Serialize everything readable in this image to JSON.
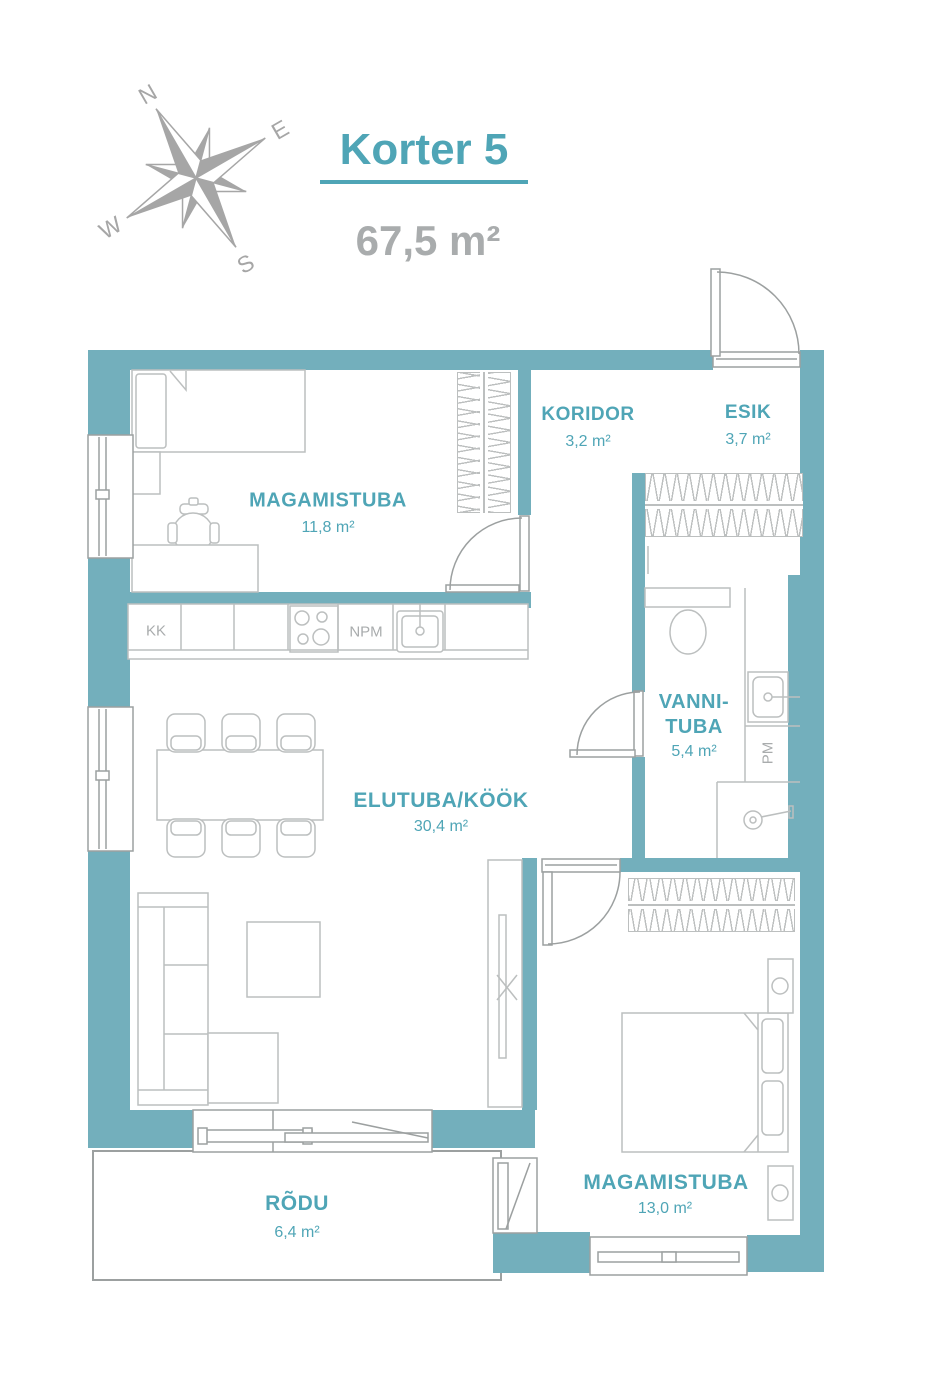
{
  "theme": {
    "wall": "#73AFBC",
    "accent": "#4FA5B6",
    "muted": "#A9ACAD",
    "line": "#BCBFBF",
    "line_dark": "#9CA0A0",
    "compass": "#A6A6A6"
  },
  "header": {
    "title": "Korter 5",
    "total_area": "67,5 m²"
  },
  "compass": {
    "n": "N",
    "e": "E",
    "s": "S",
    "w": "W"
  },
  "rooms": [
    {
      "id": "magamistuba-1",
      "name": "MAGAMISTUBA",
      "area": "11,8 m²"
    },
    {
      "id": "koridor",
      "name": "KORIDOR",
      "area": "3,2 m²"
    },
    {
      "id": "esik",
      "name": "ESIK",
      "area": "3,7 m²"
    },
    {
      "id": "vannituba",
      "name": "VANNI-TUBA",
      "area": "5,4 m²"
    },
    {
      "id": "elutuba-kook",
      "name": "ELUTUBA/KÖÖK",
      "area": "30,4 m²"
    },
    {
      "id": "magamistuba-2",
      "name": "MAGAMISTUBA",
      "area": "13,0 m²"
    },
    {
      "id": "rodu",
      "name": "RÕDU",
      "area": "6,4 m²"
    }
  ],
  "kitchen_labels": {
    "kk": "KK",
    "npm": "NPM"
  },
  "bathroom_labels": {
    "pm": "PM"
  }
}
